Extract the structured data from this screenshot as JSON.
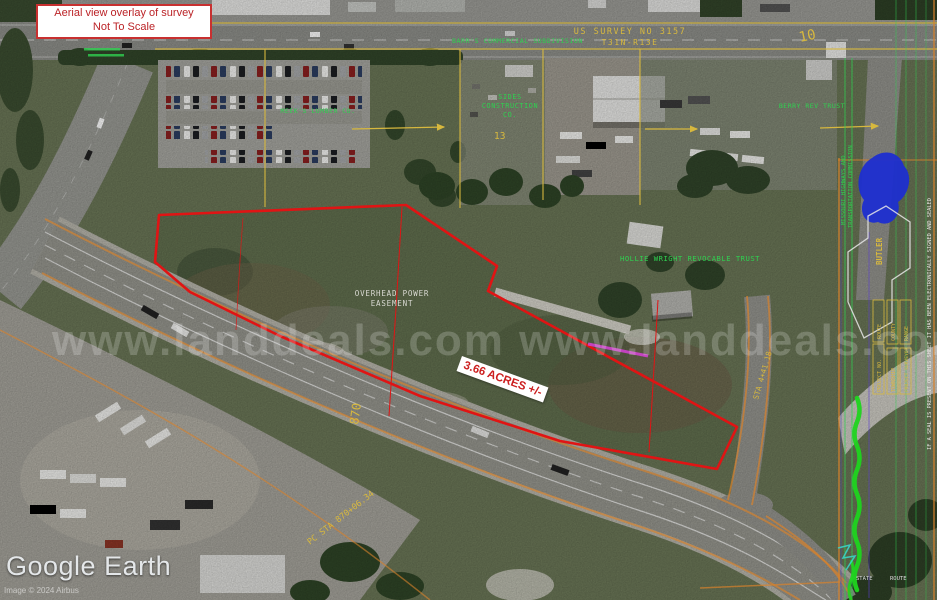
{
  "colors": {
    "boundary": "#e01414",
    "survey_yellow": "#d7b83e",
    "survey_green": "#2fd050",
    "row_orange": "#d9822b",
    "label_red": "#bb2327"
  },
  "overlay": {
    "title_line1": "Aerial view overlay of survey",
    "title_line2": "Not To Scale",
    "acreage_label": "3.66 ACRES +/-",
    "watermark": "www.landdeals.com www.landdeals.com"
  },
  "survey": {
    "us_survey_no": "US SURVEY NO 3157",
    "township_range": "T31N-R13E",
    "section_number": "10",
    "lot_number": "13",
    "subdivision": "BARR'S COMMERCIAL SUBDIVISION",
    "station_870": "870",
    "pc_station": "PC STA 870+06.34",
    "side_station": "STA 4+41.18",
    "easement_line1": "OVERHEAD POWER",
    "easement_line2": "EASEMENT"
  },
  "owners": {
    "sides_line1": "SIDES",
    "sides_line2": "CONSTRUCTION",
    "sides_line3": "CO.",
    "hollie": "HOLLIE WRIGHT REVOCABLE TRUST",
    "lumber": "MEEK'S LUMBER CO.",
    "berry": "BERRY REV TRUST"
  },
  "titleblock": {
    "agency_line1": "MISSOURI HIGHWAYS AND",
    "agency_line2": "TRANSPORTATION COMMISSION",
    "county": "BUTLER",
    "seal_note": "IF A SEAL IS PRESENT ON THIS SHEET IT HAS BEEN ELECTRONICALLY SIGNED AND SEALED",
    "field_route": "ROUTE",
    "field_project": "PROJECT NO.",
    "field_county": "COUNTY",
    "field_township": "TOWNSHIP",
    "field_range": "RANGE",
    "field_surveyor": "PROJECT SURVEYOR",
    "bottom_state": "STATE",
    "bottom_route": "ROUTE"
  },
  "attribution": {
    "logo": "Google Earth",
    "credit": "Image © 2024 Airbus"
  }
}
